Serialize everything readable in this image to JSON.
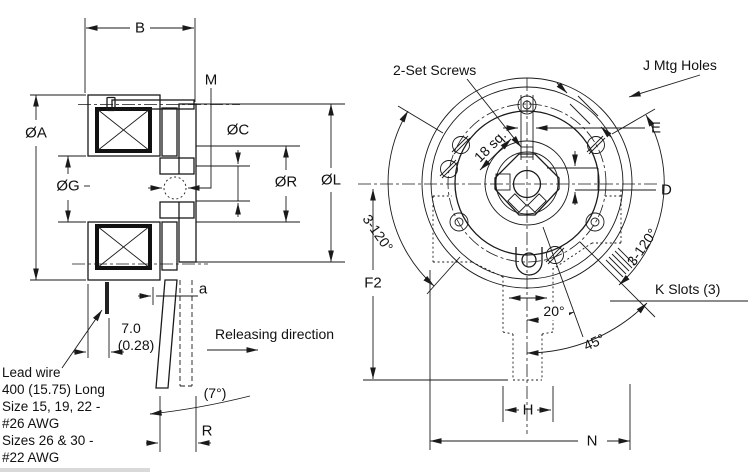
{
  "side_view": {
    "dim_width": "B",
    "dim_hub_hole": "M",
    "dim_outer_dia": "ØA",
    "dim_bore_dia": "ØG",
    "dim_c_dia": "ØC",
    "dim_r_dia": "ØR",
    "dim_l_dia": "ØL",
    "dim_gap": "a",
    "wire_offset_mm": "7.0",
    "wire_offset_in": "(0.28)",
    "lead_note": [
      "Lead wire",
      "400 (15.75) Long",
      "Size 15, 19, 22 -",
      "#26 AWG",
      "Sizes 26 & 30 -",
      "#22 AWG"
    ],
    "releasing": "Releasing direction",
    "swing_angle": "(7°)",
    "dim_lever": "R"
  },
  "front_view": {
    "set_screws": "2-Set Screws",
    "mtg_holes": "J Mtg Holes",
    "hub_square": "18 sq.",
    "dim_e": "E",
    "dim_d": "D",
    "k_slots": "K Slots (3)",
    "slot_angle_left": "3-120°",
    "slot_angle_right": "3-120°",
    "angle_20": "20°",
    "angle_45": "45°",
    "dim_f2": "F2",
    "dim_h": "H",
    "dim_n": "N"
  }
}
